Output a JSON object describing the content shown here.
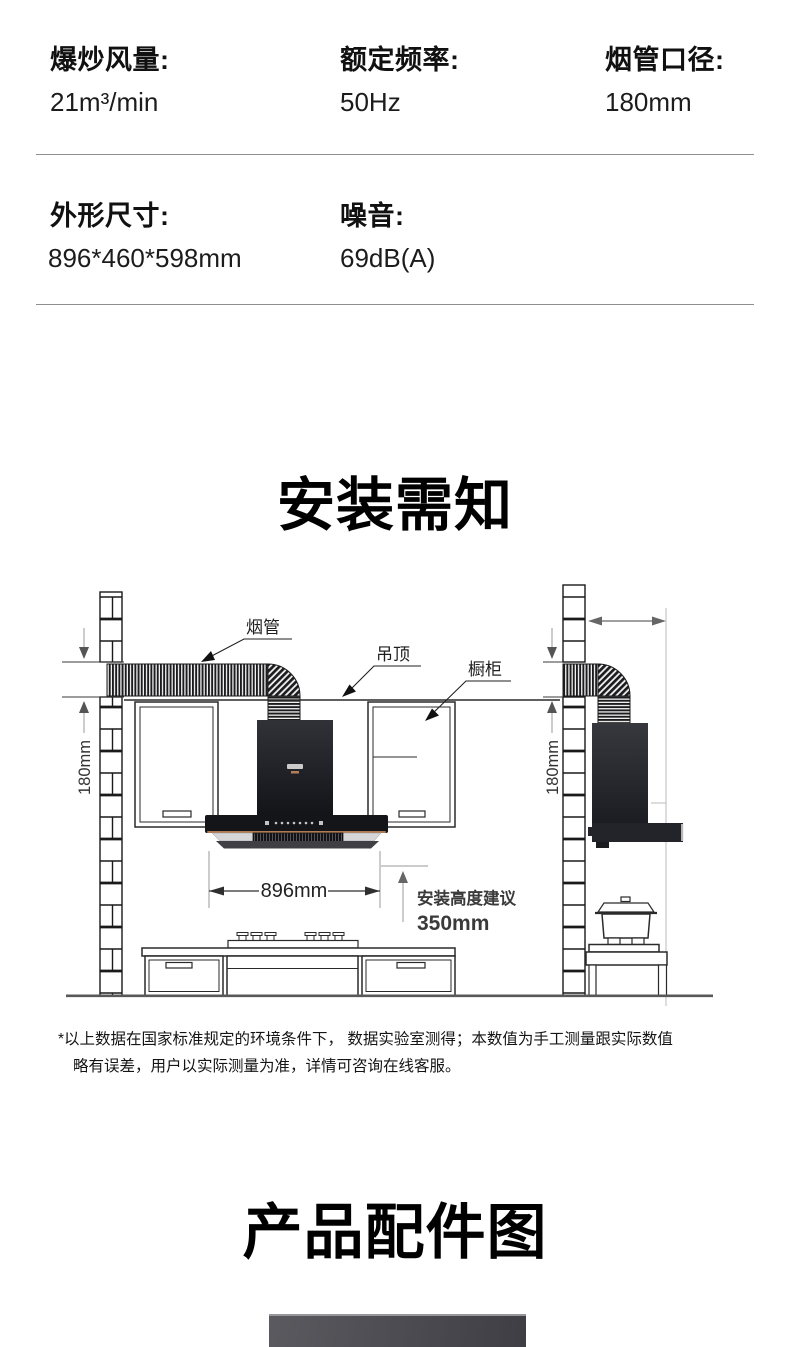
{
  "specs": {
    "row1": [
      {
        "label": "爆炒风量:",
        "value": "21m³/min"
      },
      {
        "label": "额定频率:",
        "value": "50Hz"
      },
      {
        "label": "烟管口径:",
        "value": "180mm"
      }
    ],
    "row2": [
      {
        "label": "外形尺寸:",
        "value": "896*460*598mm"
      },
      {
        "label": "噪音:",
        "value": "69dB(A)"
      }
    ]
  },
  "install_section": {
    "title": "安装需知"
  },
  "accessories_section": {
    "title": "产品配件图"
  },
  "diagram": {
    "duct_label": "烟管",
    "ceiling_label": "吊顶",
    "cabinet_label": "橱柜",
    "wall_gap_left": "180mm",
    "wall_gap_right": "180mm",
    "hood_width": "896mm",
    "install_height_label": "安装高度建议",
    "install_height_value": "350mm"
  },
  "footnote": {
    "line1": "*以上数据在国家标准规定的环境条件下， 数据实验室测得；本数值为手工测量跟实际数值",
    "line2": "略有误差，用户以实际测量为准，详情可咨询在线客服。"
  },
  "colors": {
    "text": "#1a1a1a",
    "hood_black": "#141519",
    "copper_accent": "#b07a52",
    "dimension_gray": "#555555"
  }
}
